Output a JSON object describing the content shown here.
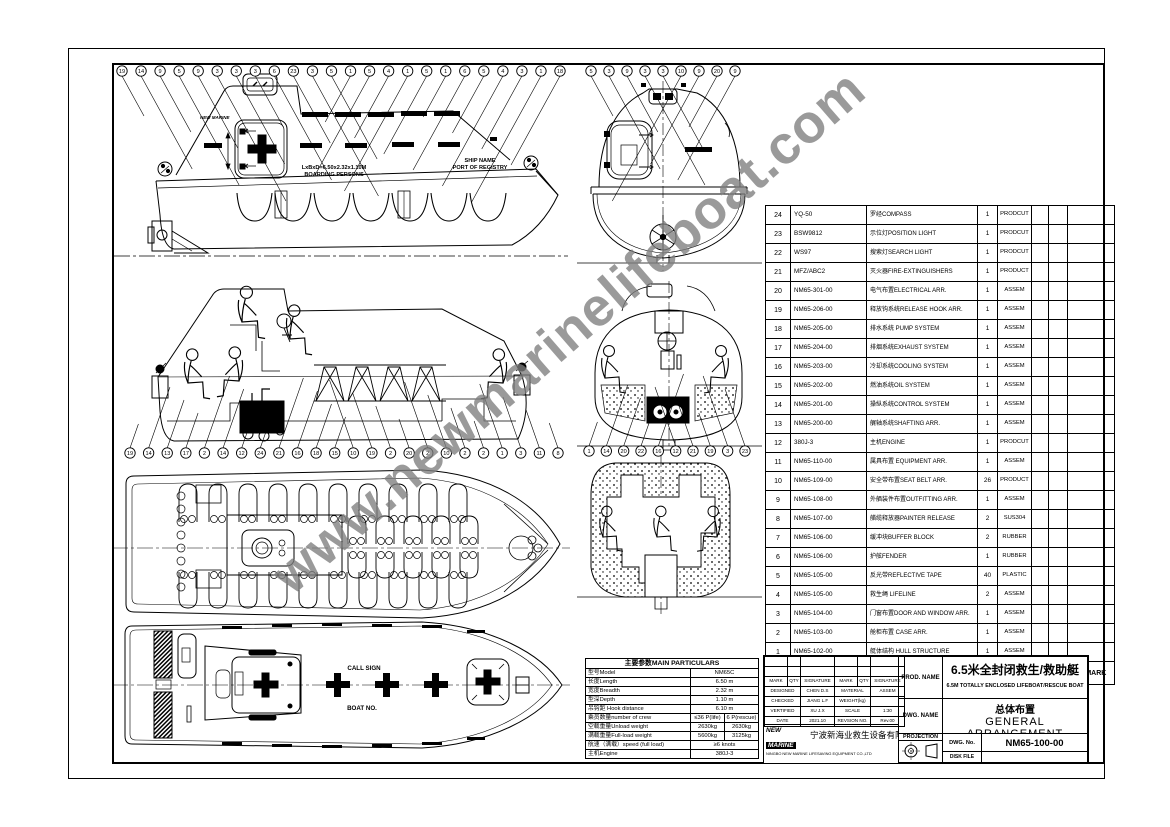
{
  "watermark": "www.newmarinelifeboat.com",
  "views": {
    "side": {
      "balloons": [
        "19",
        "14",
        "9",
        "5",
        "9",
        "3",
        "3",
        "3",
        "6",
        "23",
        "3",
        "5",
        "1",
        "5",
        "4",
        "1",
        "5",
        "1",
        "6",
        "5",
        "4",
        "3",
        "1",
        "18"
      ],
      "logo": "NEW MARINE",
      "dim_line1": "LxBxD=6.50x2.32x1.10M",
      "dim_line2": "BOARDING PERSONS",
      "ship_line1": "SHIP NAME",
      "ship_line2": "PORT OF REGISTRY"
    },
    "front": {
      "balloons": [
        "5",
        "3",
        "9",
        "3",
        "3",
        "10",
        "9",
        "20",
        "9"
      ]
    },
    "interior": {
      "balloons": [
        "19",
        "14",
        "13",
        "17",
        "2",
        "14",
        "12",
        "24",
        "21",
        "16",
        "18",
        "15",
        "10",
        "19",
        "2",
        "20",
        "2",
        "10",
        "2",
        "2",
        "1",
        "3",
        "11",
        "8"
      ]
    },
    "section": {
      "balloons": [
        "1",
        "14",
        "20",
        "22",
        "16",
        "12",
        "21",
        "19",
        "3",
        "23"
      ]
    },
    "deck": {
      "call_sign": "CALL SIGN",
      "boat_no": "BOAT NO."
    }
  },
  "parts_table": {
    "headers": {
      "no": "NO",
      "code": "CODE",
      "name": "NAME",
      "qty": "QTY.",
      "material": "MATERIAL",
      "weight_single": "SINGLE",
      "weight_total": "TOTAL",
      "weight_label": "WEIGHT(Kg)",
      "remark": "REMARK"
    },
    "rows": [
      {
        "no": "24",
        "code": "YQ-50",
        "name": "罗经COMPASS",
        "qty": "1",
        "material": "PRODCUT"
      },
      {
        "no": "23",
        "code": "BSW9812",
        "name": "示位灯POSITION LIGHT",
        "qty": "1",
        "material": "PRODCUT"
      },
      {
        "no": "22",
        "code": "WS97",
        "name": "搜索灯SEARCH LIGHT",
        "qty": "1",
        "material": "PRODCUT"
      },
      {
        "no": "21",
        "code": "MFZ/ABC2",
        "name": "灭火器FIRE-EXTINGUISHERS",
        "qty": "1",
        "material": "PRODUCT"
      },
      {
        "no": "20",
        "code": "NM65-301-00",
        "name": "电气布置ELECTRICAL ARR.",
        "qty": "1",
        "material": "ASSEM"
      },
      {
        "no": "19",
        "code": "NM65-206-00",
        "name": "释放钩系统RELEASE HOOK ARR.",
        "qty": "1",
        "material": "ASSEM"
      },
      {
        "no": "18",
        "code": "NM65-205-00",
        "name": "排水系统 PUMP SYSTEM",
        "qty": "1",
        "material": "ASSEM"
      },
      {
        "no": "17",
        "code": "NM65-204-00",
        "name": "排烟系统EXHAUST SYSTEM",
        "qty": "1",
        "material": "ASSEM"
      },
      {
        "no": "16",
        "code": "NM65-203-00",
        "name": "冷却系统COOLING SYSTEM",
        "qty": "1",
        "material": "ASSEM"
      },
      {
        "no": "15",
        "code": "NM65-202-00",
        "name": "燃油系统OIL SYSTEM",
        "qty": "1",
        "material": "ASSEM"
      },
      {
        "no": "14",
        "code": "NM65-201-00",
        "name": "操纵系统CONTROL SYSTEM",
        "qty": "1",
        "material": "ASSEM"
      },
      {
        "no": "13",
        "code": "NM65-200-00",
        "name": "艉轴系统SHAFTING ARR.",
        "qty": "1",
        "material": "ASSEM"
      },
      {
        "no": "12",
        "code": "380J-3",
        "name": "主机ENGINE",
        "qty": "1",
        "material": "PRODCUT"
      },
      {
        "no": "11",
        "code": "NM65-110-00",
        "name": "属具布置 EQUIPMENT ARR.",
        "qty": "1",
        "material": "ASSEM"
      },
      {
        "no": "10",
        "code": "NM65-109-00",
        "name": "安全带布置SEAT BELT ARR.",
        "qty": "26",
        "material": "PRODUCT"
      },
      {
        "no": "9",
        "code": "NM65-108-00",
        "name": "外舾装件布置OUTFITTING ARR.",
        "qty": "1",
        "material": "ASSEM"
      },
      {
        "no": "8",
        "code": "NM65-107-00",
        "name": "艏缆释放器PAINTER RELEASE",
        "qty": "2",
        "material": "SUS304"
      },
      {
        "no": "7",
        "code": "NM65-106-00",
        "name": "缓冲块BUFFER BLOCK",
        "qty": "2",
        "material": "RUBBER"
      },
      {
        "no": "6",
        "code": "NM65-106-00",
        "name": "护舷FENDER",
        "qty": "1",
        "material": "RUBBER"
      },
      {
        "no": "5",
        "code": "NM65-105-00",
        "name": "反光带REFLECTIVE TAPE",
        "qty": "40",
        "material": "PLASTIC"
      },
      {
        "no": "4",
        "code": "NM65-105-00",
        "name": "救生绳 LIFELINE",
        "qty": "2",
        "material": "ASSEM"
      },
      {
        "no": "3",
        "code": "NM65-104-00",
        "name": "门窗布置DOOR AND WINDOW ARR.",
        "qty": "1",
        "material": "ASSEM"
      },
      {
        "no": "2",
        "code": "NM65-103-00",
        "name": "舱柜布置 CASE ARR.",
        "qty": "1",
        "material": "ASSEM"
      },
      {
        "no": "1",
        "code": "NM65-102-00",
        "name": "艇体结构 HULL STRUCTURE",
        "qty": "1",
        "material": "ASSEM"
      }
    ]
  },
  "main_particulars": {
    "title": "主要参数MAIN PARTICULARS",
    "rows": [
      {
        "label": "型号Model",
        "v1": "NM65C",
        "v2": ""
      },
      {
        "label": "长度Length",
        "v1": "6.50 m",
        "v2": ""
      },
      {
        "label": "宽度Breadth",
        "v1": "2.32 m",
        "v2": ""
      },
      {
        "label": "型深Depth",
        "v1": "1.10 m",
        "v2": ""
      },
      {
        "label": "吊钩距 Hook distance",
        "v1": "6.10 m",
        "v2": ""
      },
      {
        "label": "乘员数量number of crew",
        "v1": "≤36 P(life)",
        "v2": "6 P(rescue)"
      },
      {
        "label": "空载重量Unload weight",
        "v1": "2630kg",
        "v2": "2630kg"
      },
      {
        "label": "满载重量Full-load weight",
        "v1": "5600kg",
        "v2": "3125kg"
      },
      {
        "label": "航速（满载）speed (full load)",
        "v1": "≥6 knots",
        "v2": ""
      },
      {
        "label": "主机Engine",
        "v1": "380J-3",
        "v2": ""
      }
    ]
  },
  "title_block": {
    "prod_name_label": "PROD. NAME",
    "prod_cn": "6.5米全封闭救生/救助艇",
    "prod_en": "6.5M TOTALLY ENCLOSED LIFEBOAT/RESCUE BOAT",
    "dwg_name_label": "DWG. NAME",
    "dwg_cn": "总体布置",
    "dwg_en": "GENERAL ARRANGEMENT",
    "projection_label": "PROJECTION",
    "dwg_no_label": "DWG. No.",
    "dwg_no": "NM65-100-00",
    "disk_file_label": "DISK FILE",
    "company_logo_line1": "NEW",
    "company_logo_line2": "MARINE",
    "company_cn": "宁波新海业救生设备有限公司",
    "company_en": "NINGBO NEW MARINE LIFESAVING EQUIPMENT CO.,LTD",
    "sign": {
      "headers": [
        "MARK",
        "QTY",
        "SIGNATURE",
        "MARK",
        "QTY",
        "SIGNATURE"
      ],
      "rows": [
        [
          "DESIGNED",
          "CHEN D.S",
          "MATERIAL",
          "ASSEM"
        ],
        [
          "CHECKED",
          "JIANG L.F",
          "WEIGHT(kg)",
          ""
        ],
        [
          "VERTIFIED",
          "XU J.X",
          "SCALE",
          "1:30"
        ],
        [
          "DATE",
          "2021.10",
          "REVSION NO.",
          "Rev.00"
        ]
      ]
    }
  }
}
